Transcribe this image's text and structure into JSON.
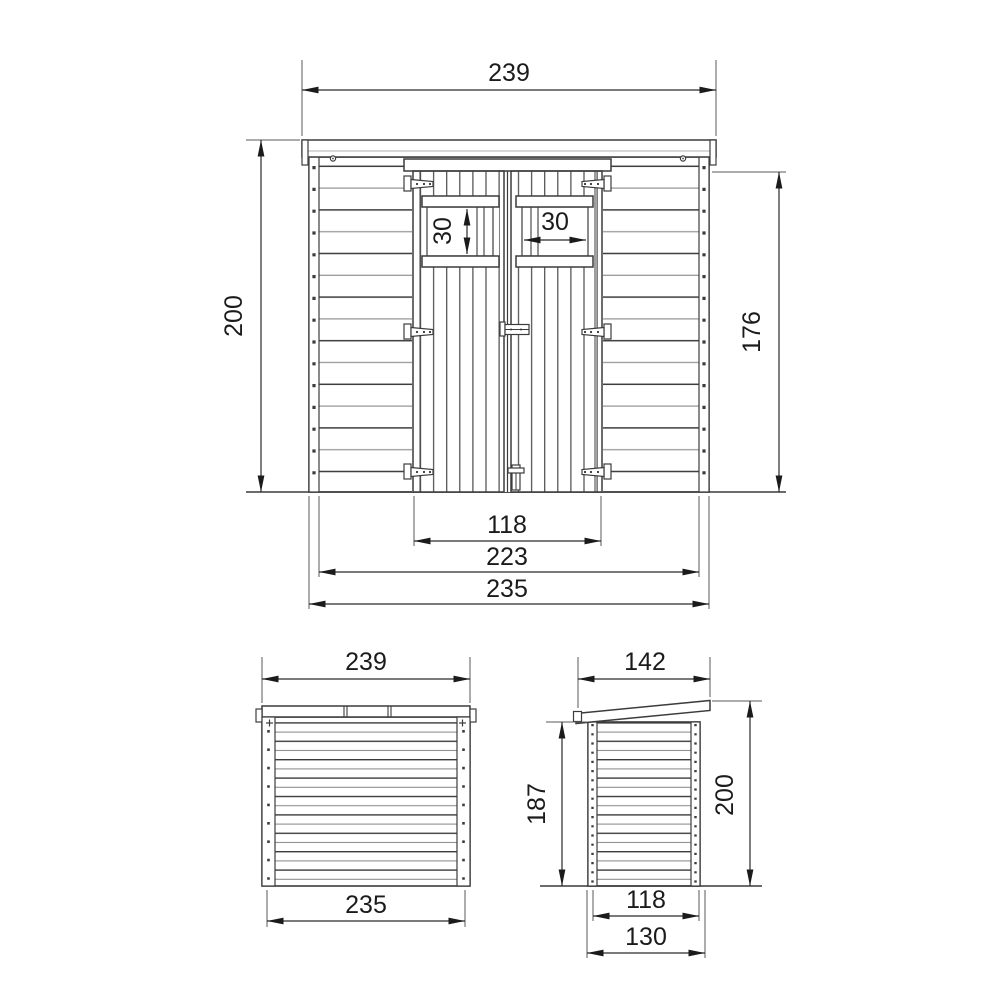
{
  "drawing": {
    "type": "technical-drawing",
    "subject": "wooden shed with double doors",
    "views": [
      "front",
      "top",
      "side"
    ]
  },
  "views": {
    "front": {
      "dims": {
        "roof_width": "239",
        "total_height": "200",
        "wall_height": "176",
        "window_height": "30",
        "window_width": "30",
        "door_opening_width": "118",
        "door_frame_width": "223",
        "wall_width": "235"
      }
    },
    "top": {
      "dims": {
        "roof_width": "239",
        "wall_width": "235"
      }
    },
    "side": {
      "dims": {
        "roof_depth": "142",
        "back_wall_height": "187",
        "total_height": "200",
        "floor_depth": "118",
        "base_depth": "130"
      }
    }
  },
  "colors": {
    "line": "#3c3c3c",
    "line_light": "#9a9a9a",
    "dimension": "#1b1b1b",
    "background": "#ffffff"
  }
}
